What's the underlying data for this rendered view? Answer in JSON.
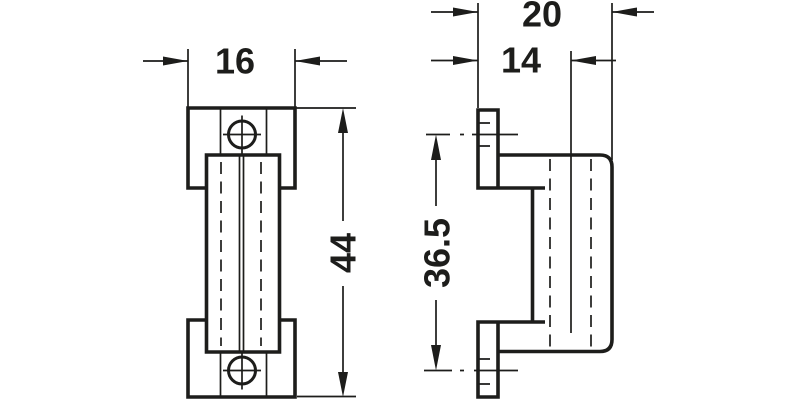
{
  "drawing": {
    "kind": "two-view orthographic technical drawing of furniture fitting",
    "background_color": "#ffffff",
    "line_color": "#1d1d1b",
    "views": {
      "front": {
        "label": "front-view",
        "dims": {
          "width": "16",
          "height": "44"
        }
      },
      "side": {
        "label": "side-view",
        "dims": {
          "overall_depth": "20",
          "body_depth": "14",
          "hole_spacing": "36.5"
        }
      }
    }
  }
}
